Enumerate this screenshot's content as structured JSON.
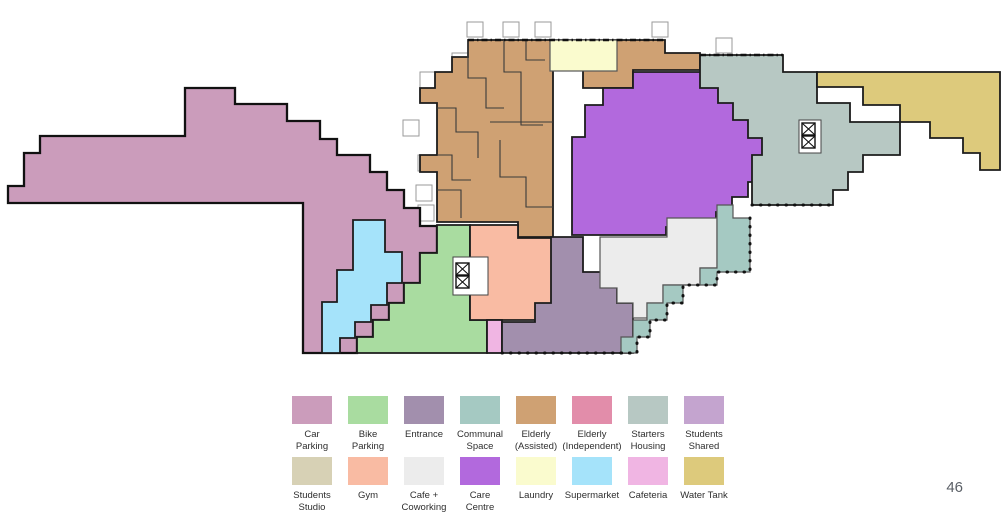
{
  "page": {
    "number": "46"
  },
  "colors": {
    "carParking": "#cb9cbb",
    "bikeParking": "#a9dca0",
    "entrance": "#a28fad",
    "communalSpace": "#a5c9c2",
    "elderlyAssisted": "#cfa173",
    "elderlyIndependent": "#e28daa",
    "startersHousing": "#b7c8c3",
    "studentsShared": "#c4a4cf",
    "studentsStudio": "#d7d1b5",
    "gym": "#f9bba3",
    "cafeCoworking": "#ececec",
    "careCentre": "#b269dd",
    "laundry": "#fafbce",
    "supermarket": "#a5e3fa",
    "cafeteria": "#f0b5e3",
    "waterTank": "#ddca7c"
  },
  "legend": {
    "rows": [
      [
        {
          "key": "carParking",
          "label": "Car\nParking"
        },
        {
          "key": "bikeParking",
          "label": "Bike\nParking"
        },
        {
          "key": "entrance",
          "label": "Entrance"
        },
        {
          "key": "communalSpace",
          "label": "Communal\nSpace"
        },
        {
          "key": "elderlyAssisted",
          "label": "Elderly\n(Assisted)"
        },
        {
          "key": "elderlyIndependent",
          "label": "Elderly\n(Independent)"
        },
        {
          "key": "startersHousing",
          "label": "Starters\nHousing"
        },
        {
          "key": "studentsShared",
          "label": "Students\nShared"
        }
      ],
      [
        {
          "key": "studentsStudio",
          "label": "Students\nStudio"
        },
        {
          "key": "gym",
          "label": "Gym"
        },
        {
          "key": "cafeCoworking",
          "label": "Cafe +\nCoworking"
        },
        {
          "key": "careCentre",
          "label": "Care\nCentre"
        },
        {
          "key": "laundry",
          "label": "Laundry"
        },
        {
          "key": "supermarket",
          "label": "Supermarket"
        },
        {
          "key": "cafeteria",
          "label": "Cafeteria"
        },
        {
          "key": "waterTank",
          "label": "Water Tank"
        }
      ]
    ]
  },
  "plan": {
    "type": "floor-plan",
    "elevator_icon": "boxed-x",
    "regions_visible": [
      "carParking",
      "supermarket",
      "bikeParking",
      "elderlyAssisted",
      "laundry",
      "careCentre",
      "gym",
      "cafeteria",
      "entrance",
      "cafeCoworking",
      "communalSpace",
      "startersHousing",
      "waterTank"
    ]
  }
}
